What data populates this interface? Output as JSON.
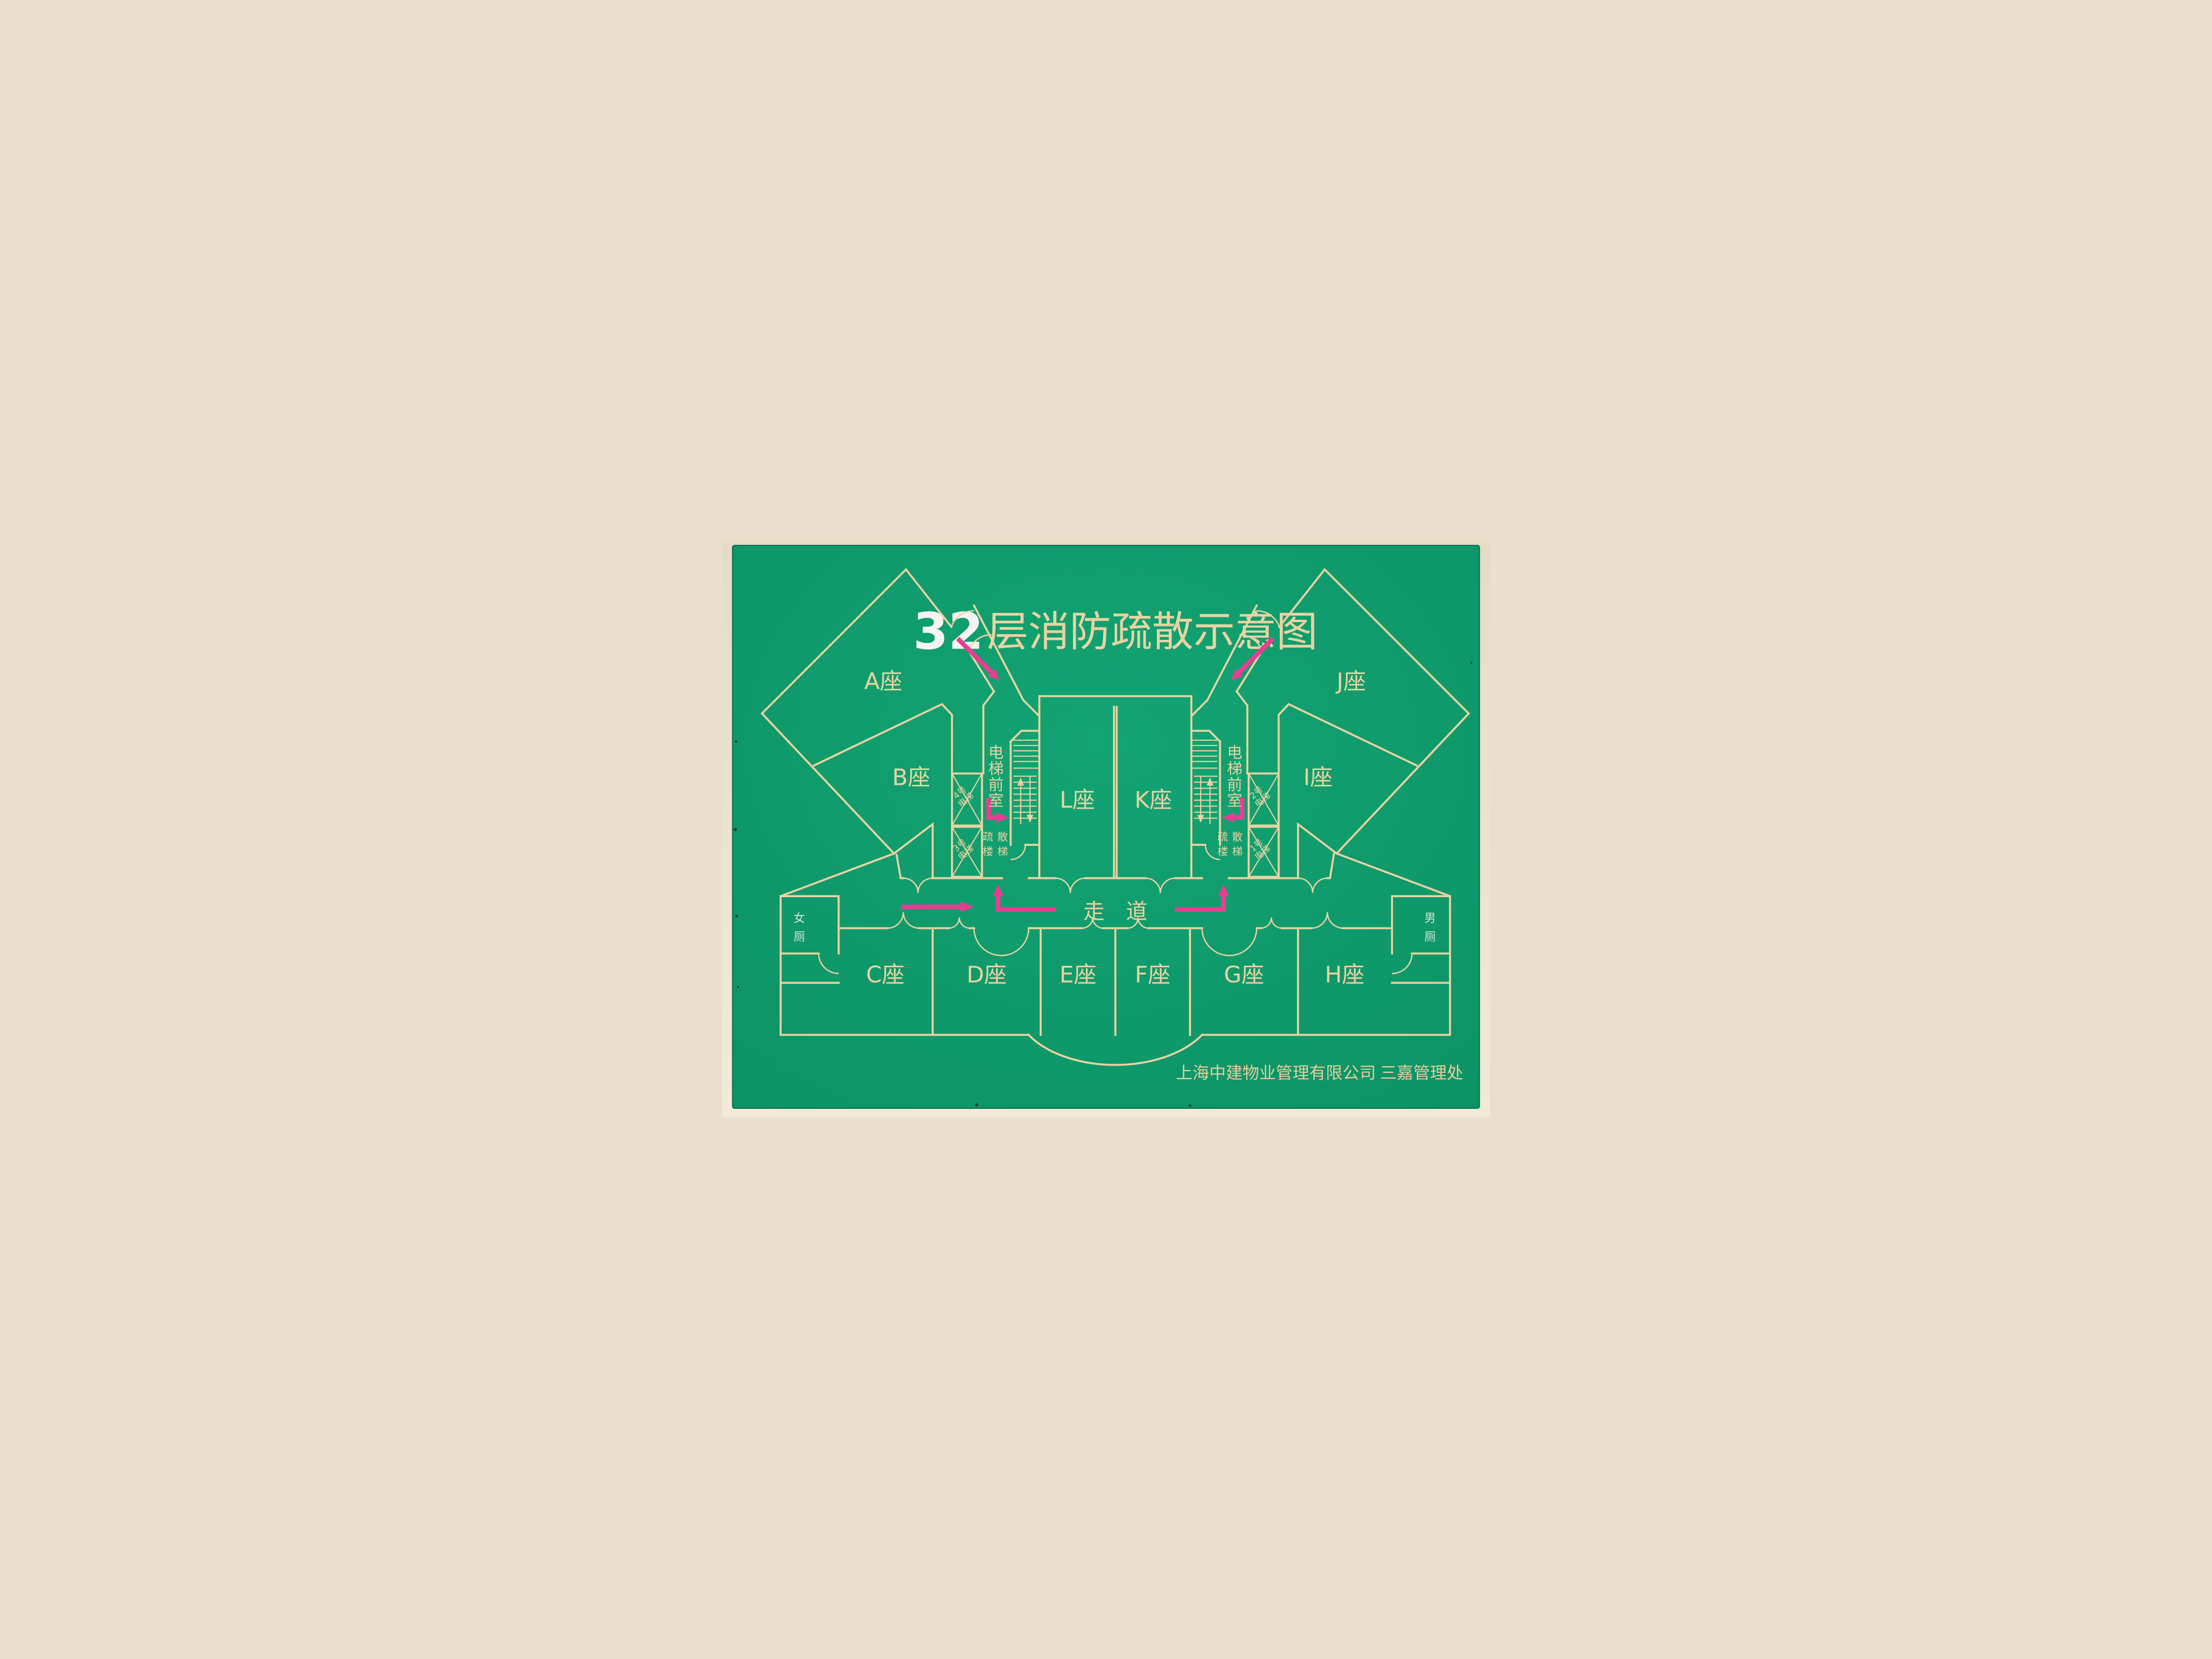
{
  "title": {
    "floor": "32",
    "suffix": "层消防疏散示意图"
  },
  "corridor_label": "走道",
  "lobby_label": "电梯前室",
  "stair_label": "疏散楼梯",
  "toilets": {
    "female": "女厕",
    "male": "男厕"
  },
  "blocks": {
    "A": "A座",
    "B": "B座",
    "C": "C座",
    "D": "D座",
    "E": "E座",
    "F": "F座",
    "G": "G座",
    "H": "H座",
    "I": "I座",
    "J": "J座",
    "K": "K座",
    "L": "L座"
  },
  "elevators": [
    {
      "no": "4号",
      "word": "电梯"
    },
    {
      "no": "3号",
      "word": "电梯"
    },
    {
      "no": "2号",
      "word": "电梯"
    },
    {
      "no": "1号",
      "word": "电梯"
    }
  ],
  "footer": "上海中建物业管理有限公司 三嘉管理处",
  "colors": {
    "board_green": "#0f9d6e",
    "line_tan": "#e9d3a2",
    "arrow_pink": "#e83e92",
    "wall_beige": "#e9dfca",
    "title_white": "#f4f4f2",
    "toilet_text": "#d8e9da"
  }
}
